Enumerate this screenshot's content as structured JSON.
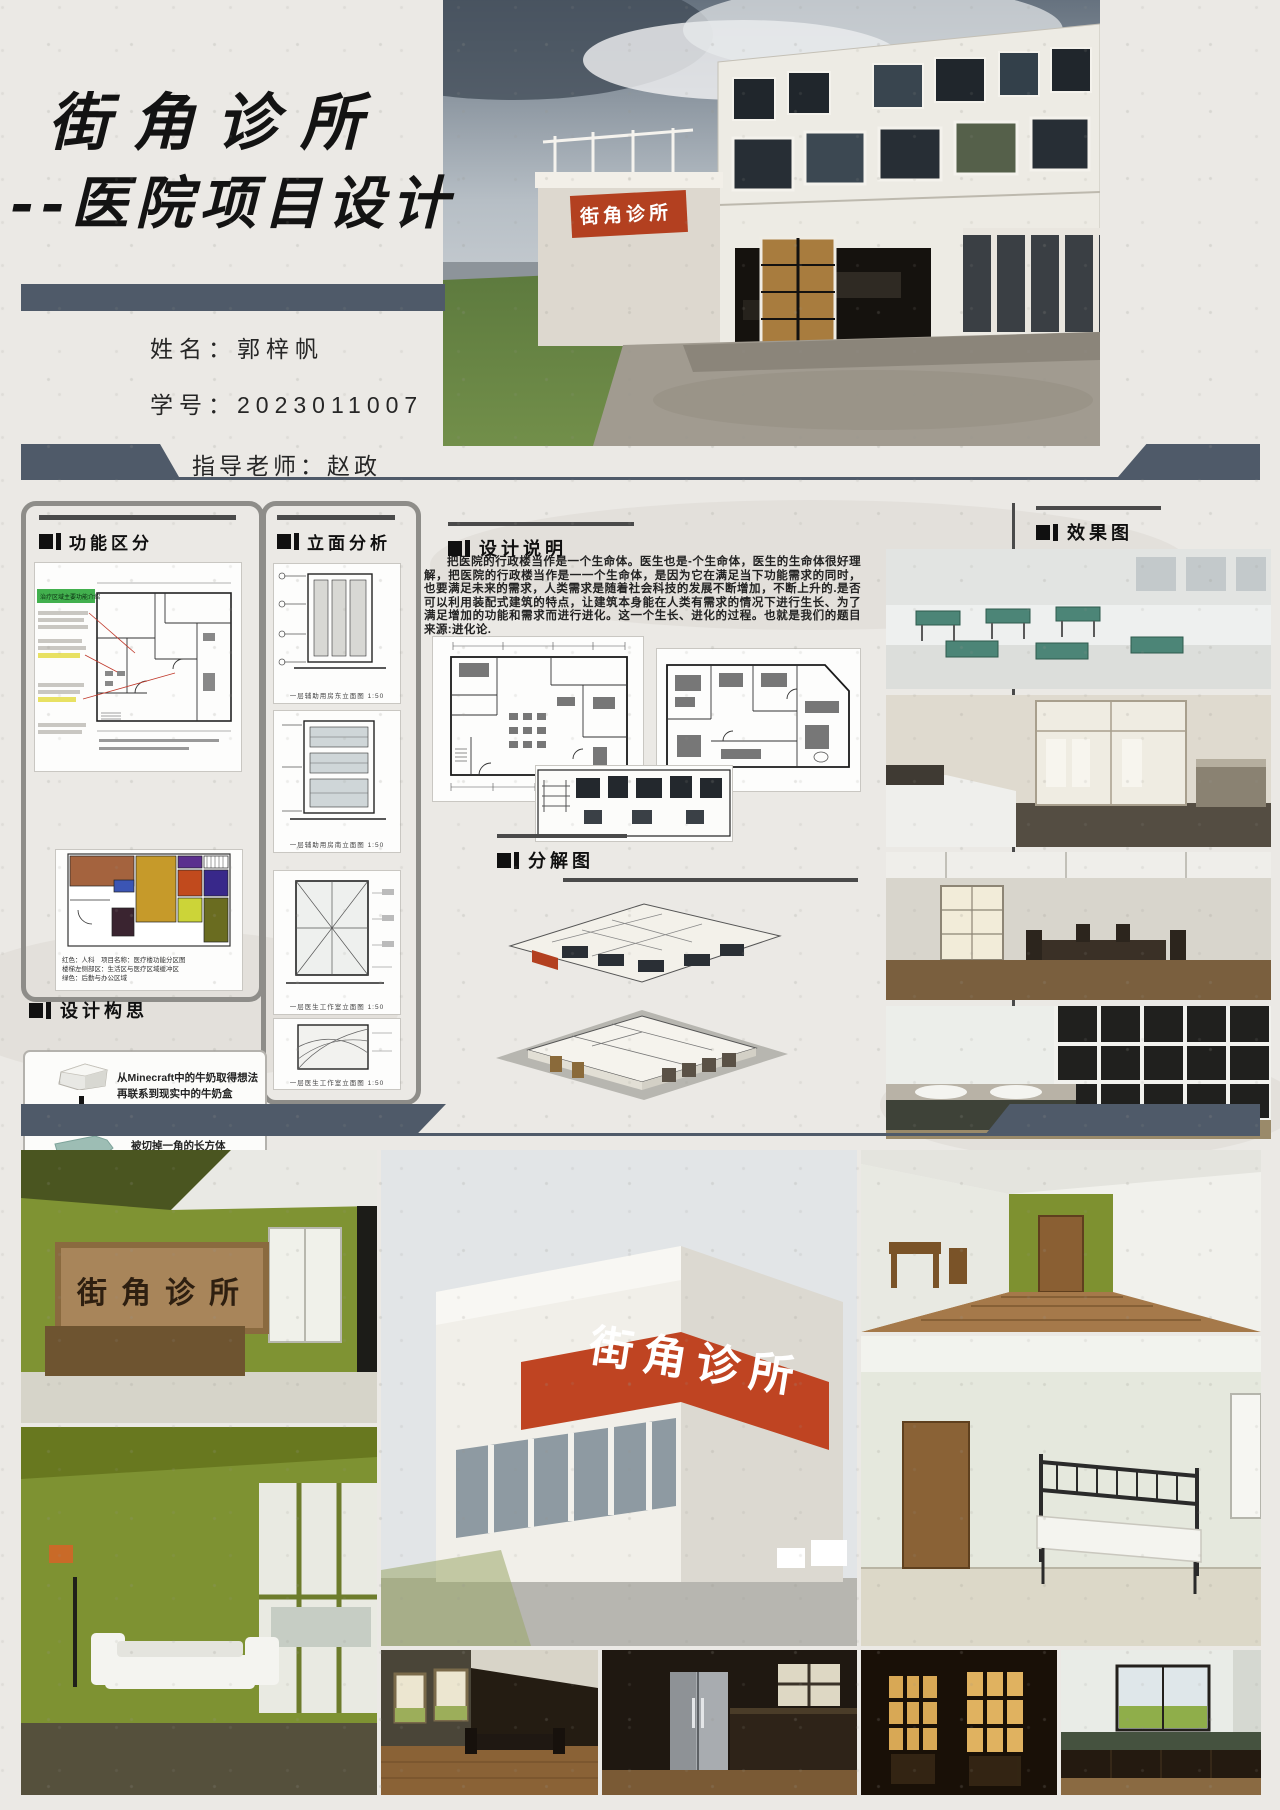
{
  "poster": {
    "title_line1": "街角诊所",
    "title_line2": "--医院项目设计",
    "student_name": "姓名：郭梓帆",
    "student_id": "学号：2023011007",
    "advisor": "指导老师：赵政",
    "clinic_sign": "街角诊所"
  },
  "sections": {
    "functional": {
      "title": "功能区分",
      "plan_note_green": "治疗区域主要功能介绍",
      "zoning_legend": [
        "红色：人科　项目名称：医疗楼功能分区图",
        "楼梯左侧部区：生活区与医疗区域缓冲区",
        "绿色：后勤与办公区域"
      ]
    },
    "elevation": {
      "title": "立面分析",
      "captions": [
        "一层辅助用房东立面图 1:50",
        "一层辅助用房南立面图 1:50",
        "一层医生工作室立面图 1:50",
        "一层医生工作室立面图 1:50"
      ]
    },
    "description": {
      "title": "设计说明",
      "body": "把医院的行政楼当作是一个生命体。医生也是-个生命体，医生的生命体很好理解，把医院的行政楼当作是一一个生命体，是因为它在满足当下功能需求的同时，也要满足未来的需求，人类需求是随着社会科技的发展不断增加，不断上升的.是否可以利用装配式建筑的特点，让建筑本身能在人类有需求的情况下进行生长、为了满足增加的功能和需求而进行进化。这一个生长、进化的过程。也就是我们的题目来源:进化论."
    },
    "exploded": {
      "title": "分解图"
    },
    "renderings": {
      "title": "效果图"
    },
    "concept": {
      "title": "设计构思",
      "steps": [
        {
          "l1": "从Minecraft中的牛奶取得想法",
          "l2": "再联系到现实中的牛奶盒"
        },
        {
          "l1": "牛奶盒就像是一个",
          "l2": "被切掉一角的长方体"
        },
        {
          "l1": "最后通过这个切角长方体",
          "l2": "演变出了一整个建筑外观"
        }
      ]
    }
  },
  "colors": {
    "accent_slate": "#4f5a69",
    "sign_red": "#b34020",
    "wall_green": "#7f9333",
    "header_bar": "#4a4a4a"
  }
}
